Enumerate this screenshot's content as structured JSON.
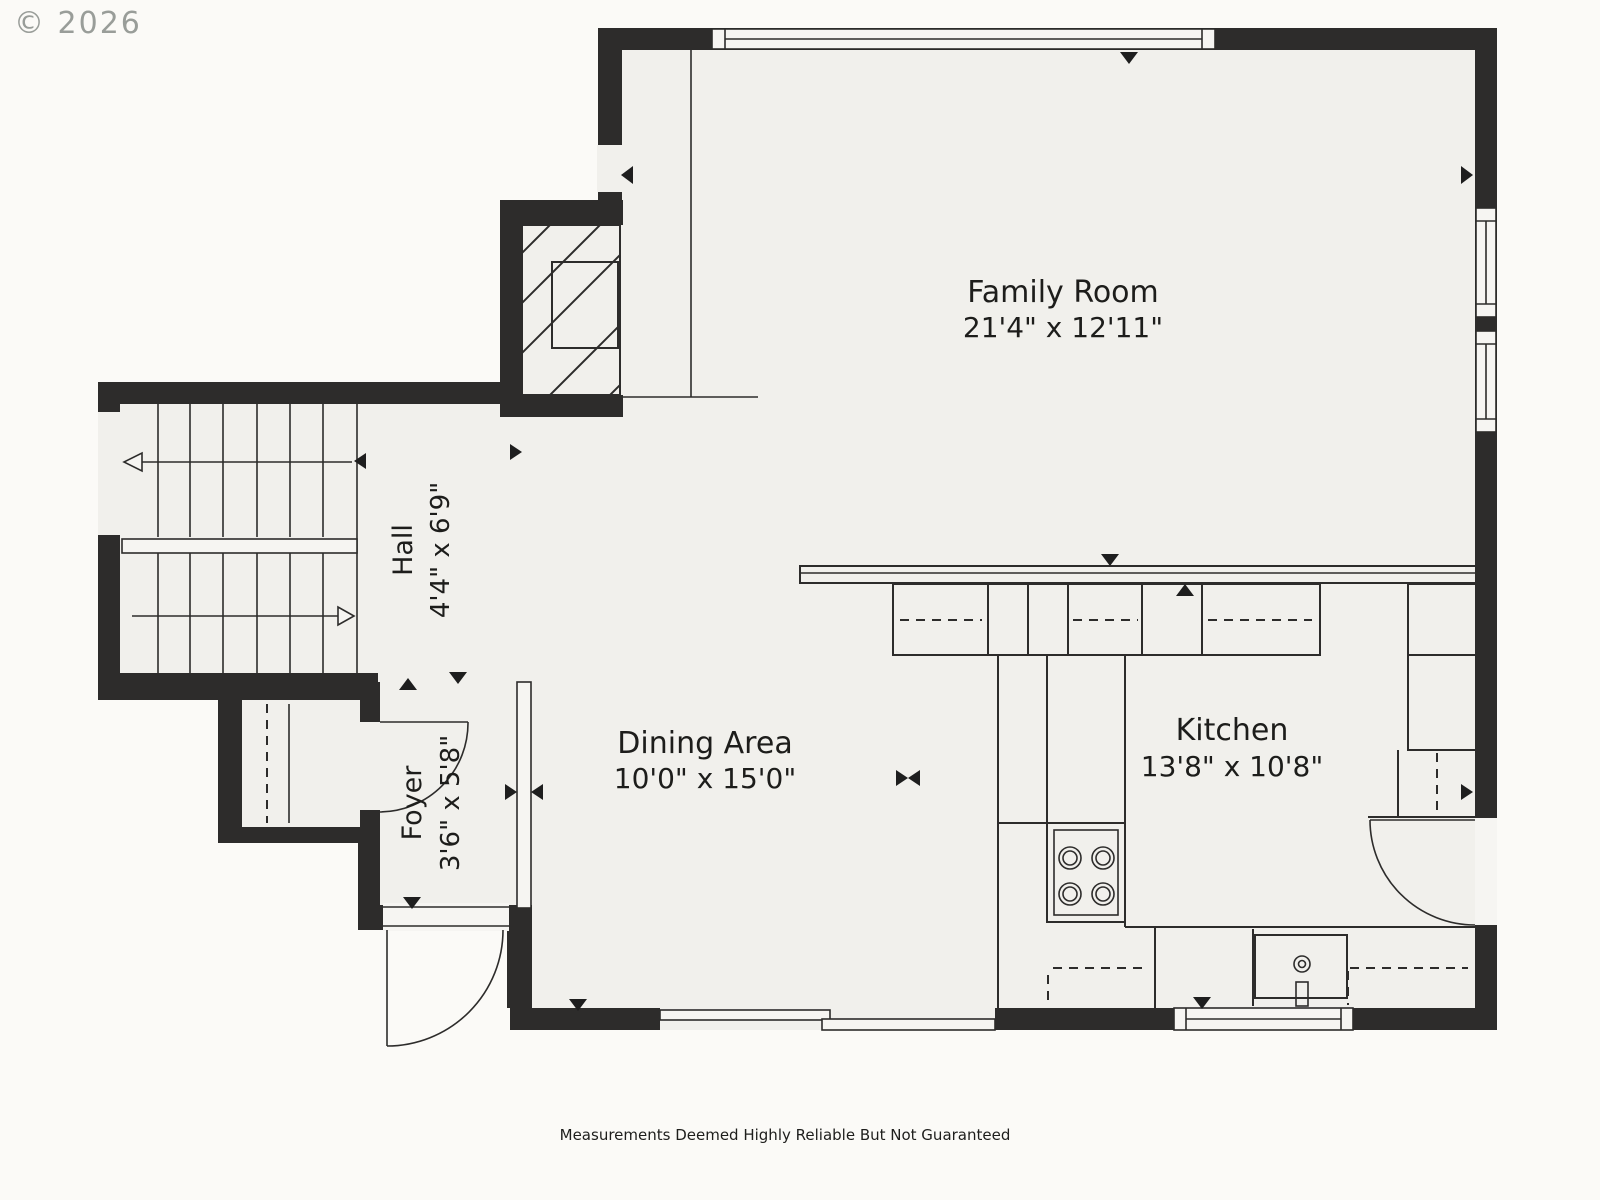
{
  "copyright": "© 2026",
  "footer": "Measurements Deemed Highly Reliable But Not Guaranteed",
  "rooms": {
    "family_room": {
      "name": "Family Room",
      "dims": "21'4\" x 12'11\""
    },
    "kitchen": {
      "name": "Kitchen",
      "dims": "13'8\" x 10'8\""
    },
    "dining": {
      "name": "Dining Area",
      "dims": "10'0\" x 15'0\""
    },
    "hall": {
      "name": "Hall",
      "dims": "4'4\" x 6'9\""
    },
    "foyer": {
      "name": "Foyer",
      "dims": "3'6\" x 5'8\""
    }
  },
  "colors": {
    "wall": "#2d2c2b",
    "floor": "#f1f0ec",
    "background": "#fbfaf7",
    "text": "#1d1d1b",
    "copyright_gray": "#8f948f"
  }
}
